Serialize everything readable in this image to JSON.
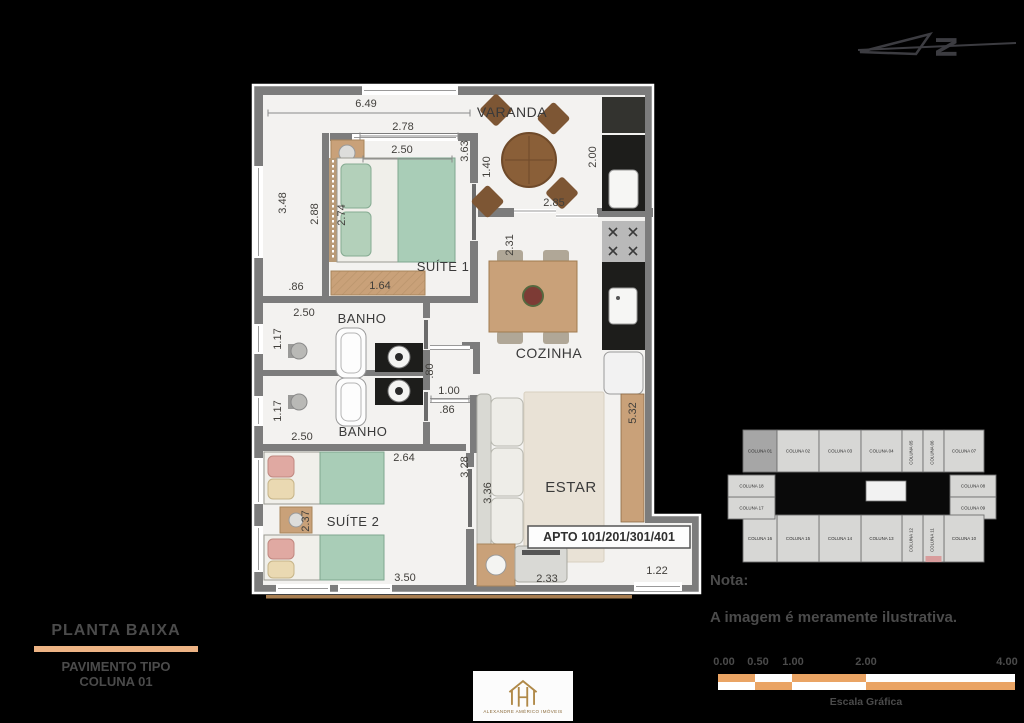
{
  "north": {
    "letter": "N"
  },
  "plan": {
    "apto_label": "APTO 101/201/301/401",
    "texts": [
      {
        "t": "VARANDA",
        "x": 512,
        "y": 117,
        "s": 14,
        "c": "room"
      },
      {
        "t": "SUÍTE 1",
        "x": 443,
        "y": 271,
        "s": 13,
        "c": "room"
      },
      {
        "t": "BANHO",
        "x": 362,
        "y": 323,
        "s": 13,
        "c": "room"
      },
      {
        "t": "COZINHA",
        "x": 549,
        "y": 358,
        "s": 14,
        "c": "room"
      },
      {
        "t": "BANHO",
        "x": 363,
        "y": 436,
        "s": 13,
        "c": "room"
      },
      {
        "t": "ESTAR",
        "x": 571,
        "y": 492,
        "s": 15,
        "c": "room"
      },
      {
        "t": "SUÍTE 2",
        "x": 353,
        "y": 526,
        "s": 13,
        "c": "room"
      },
      {
        "t": "6.49",
        "x": 366,
        "y": 107,
        "l": [
          268,
          113,
          470,
          113
        ]
      },
      {
        "t": "2.78",
        "x": 403,
        "y": 130,
        "l": [
          360,
          136,
          458,
          136
        ]
      },
      {
        "t": "2.50",
        "x": 402,
        "y": 153,
        "l": [
          363,
          159,
          452,
          159
        ]
      },
      {
        "t": "3.48",
        "x": 286,
        "y": 203,
        "r": 1
      },
      {
        "t": "2.88",
        "x": 318,
        "y": 214,
        "r": 1
      },
      {
        "t": "2.74",
        "x": 345,
        "y": 215,
        "r": 1
      },
      {
        "t": "3.63",
        "x": 468,
        "y": 151,
        "r": 1
      },
      {
        "t": "1.40",
        "x": 490,
        "y": 167,
        "r": 1
      },
      {
        "t": "2.00",
        "x": 596,
        "y": 157,
        "r": 1
      },
      {
        "t": "2.85",
        "x": 554,
        "y": 206
      },
      {
        "t": "2.31",
        "x": 513,
        "y": 245,
        "r": 1
      },
      {
        "t": ".86",
        "x": 296,
        "y": 290
      },
      {
        "t": "1.64",
        "x": 380,
        "y": 289
      },
      {
        "t": "2.50",
        "x": 304,
        "y": 316
      },
      {
        "t": "1.17",
        "x": 281,
        "y": 339,
        "r": 1
      },
      {
        "t": "1.17",
        "x": 281,
        "y": 411,
        "r": 1
      },
      {
        "t": "2.50",
        "x": 302,
        "y": 440
      },
      {
        "t": ".80",
        "x": 433,
        "y": 371,
        "r": 1
      },
      {
        "t": "1.00",
        "x": 449,
        "y": 394,
        "l": [
          431,
          399,
          469,
          399
        ]
      },
      {
        "t": ".86",
        "x": 447,
        "y": 413
      },
      {
        "t": "2.64",
        "x": 404,
        "y": 461
      },
      {
        "t": "3.28",
        "x": 468,
        "y": 467,
        "r": 1
      },
      {
        "t": "3.36",
        "x": 491,
        "y": 493,
        "r": 1
      },
      {
        "t": "2.37",
        "x": 309,
        "y": 521,
        "r": 1
      },
      {
        "t": "5.32",
        "x": 636,
        "y": 413,
        "r": 1
      },
      {
        "t": "3.50",
        "x": 405,
        "y": 581
      },
      {
        "t": "2.33",
        "x": 547,
        "y": 582
      },
      {
        "t": "1.22",
        "x": 657,
        "y": 574
      }
    ]
  },
  "keyplan": {
    "units": [
      {
        "label": "COLUNA 01",
        "x": 743,
        "y": 430,
        "w": 34,
        "h": 42,
        "hl": 1
      },
      {
        "label": "COLUNA 02",
        "x": 777,
        "y": 430,
        "w": 42,
        "h": 42
      },
      {
        "label": "COLUNA 03",
        "x": 819,
        "y": 430,
        "w": 42,
        "h": 42
      },
      {
        "label": "COLUNA 04",
        "x": 861,
        "y": 430,
        "w": 41,
        "h": 42
      },
      {
        "label": "COLUNA 05",
        "x": 902,
        "y": 430,
        "w": 21,
        "h": 42,
        "rot": 1
      },
      {
        "label": "COLUNA 06",
        "x": 923,
        "y": 430,
        "w": 21,
        "h": 42,
        "rot": 1
      },
      {
        "label": "COLUNA 07",
        "x": 944,
        "y": 430,
        "w": 40,
        "h": 42
      },
      {
        "label": "COLUNA 08",
        "x": 950,
        "y": 475,
        "w": 46,
        "h": 22
      },
      {
        "label": "COLUNA 09",
        "x": 950,
        "y": 497,
        "w": 46,
        "h": 22
      },
      {
        "label": "COLUNA 10",
        "x": 944,
        "y": 515,
        "w": 40,
        "h": 47
      },
      {
        "label": "COLUNA 11",
        "x": 923,
        "y": 515,
        "w": 21,
        "h": 47,
        "rot": 1,
        "red": 1
      },
      {
        "label": "COLUNA 12",
        "x": 902,
        "y": 515,
        "w": 21,
        "h": 47,
        "rot": 1
      },
      {
        "label": "COLUNA 13",
        "x": 861,
        "y": 515,
        "w": 41,
        "h": 47
      },
      {
        "label": "COLUNA 14",
        "x": 819,
        "y": 515,
        "w": 42,
        "h": 47
      },
      {
        "label": "COLUNA 15",
        "x": 777,
        "y": 515,
        "w": 42,
        "h": 47
      },
      {
        "label": "COLUNA 16",
        "x": 743,
        "y": 515,
        "w": 34,
        "h": 47
      },
      {
        "label": "COLUNA 17",
        "x": 728,
        "y": 497,
        "w": 47,
        "h": 22
      },
      {
        "label": "COLUNA 18",
        "x": 728,
        "y": 475,
        "w": 47,
        "h": 22
      }
    ]
  },
  "nota": {
    "title": "Nota:",
    "body": "A imagem é meramente ilustrativa."
  },
  "scalebar": {
    "ticks": [
      "0.00",
      "0.50",
      "1.00",
      "2.00",
      "4.00"
    ],
    "caption": "Escala Gráfica"
  },
  "titleblock": {
    "title": "PLANTA BAIXA",
    "sub1": "PAVIMENTO TIPO",
    "sub2": "COLUNA 01"
  },
  "logo": {
    "name": "ALEXANDRE AMÉRICO IMÓVEIS"
  },
  "colors": {
    "accent_orange": "#eaa464",
    "titlebar_orange": "#edb384",
    "wall_gray": "#7c7c7c",
    "floor": "#f3f2f0",
    "wood": "#c9a179",
    "dark_counter": "#1d1d1b",
    "bedding_teal": "#a9cdb7",
    "rug": "#e9e2d6",
    "text_gray": "#4b4b4b",
    "keyplan_fill": "#d7d7d5",
    "keyplan_highlight": "#a6a6a6",
    "keyplan_red": "#d89c9c"
  }
}
